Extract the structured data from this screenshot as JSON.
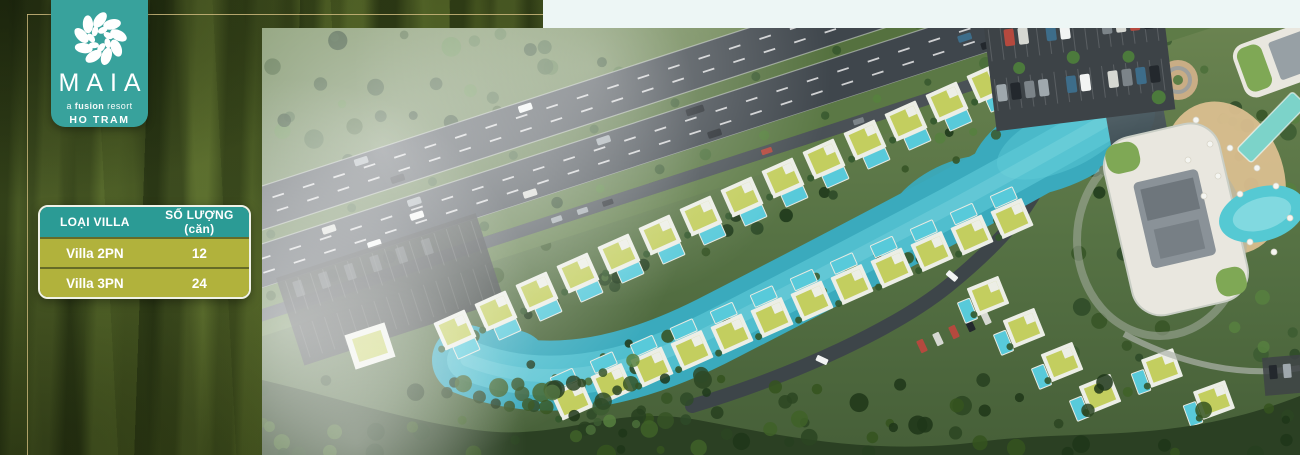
{
  "brand": {
    "name": "MAIA",
    "tagline_pre": "a ",
    "tagline_bold": "fusion",
    "tagline_post": " resort",
    "location": "HO TRAM",
    "logo_icon": "flower-swirl"
  },
  "villa_table": {
    "headers": [
      "LOẠI VILLA",
      "SỐ LƯỢNG (căn)"
    ],
    "rows": [
      [
        "Villa 2PN",
        "12"
      ],
      [
        "Villa 3PN",
        "24"
      ]
    ]
  },
  "colors": {
    "badge_teal": "#38a29c",
    "table_header_teal": "#2b9b95",
    "table_row_olive": "#b1b23c",
    "border_gold": "#cdb97d",
    "top_strip": "#edf6f5",
    "lagoon": "#3aaabd",
    "lagoon_light": "#5fccd8",
    "villa_roof": "#c3ce5f",
    "pool": "#58cada",
    "asphalt": "#3f464c",
    "grass": "#5f7b46",
    "forest": "#2b4023",
    "sand": "#d9bd8f",
    "building_white": "#e9e7df"
  }
}
